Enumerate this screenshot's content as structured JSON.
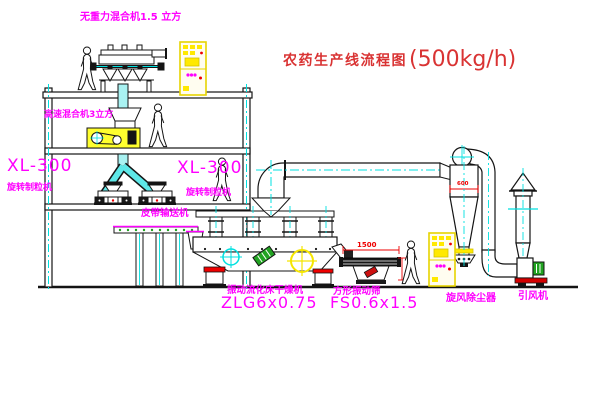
{
  "title": {
    "text": "农药生产线流程图",
    "capacity": "(500kg/h)"
  },
  "labels": {
    "gravity_mixer": "无重力混合机1.5 立方",
    "high_speed_mixer": "高速混合机3立方",
    "granulator_left_model": "XL-300",
    "granulator_left_name": "旋转制粒机",
    "granulator_right_model": "XL-300",
    "granulator_right_name": "旋转制粒机",
    "belt_conveyor": "皮带输送机",
    "dryer_name": "振动流化床干燥机",
    "dryer_model": "ZLG6x0.75",
    "sieve_name": "方形振动筛",
    "sieve_model": "FS0.6x1.5",
    "cyclone": "旋风除尘器",
    "fan": "引风机"
  },
  "dimensions": {
    "cyclone_diameter": "600",
    "sieve_length": "1500"
  },
  "colors": {
    "label_magenta": "#ff00ff",
    "title_red": "#d93333",
    "dimension_red": "#ee0000",
    "highlight_yellow": "#ffe900",
    "pipe_cyan": "#00e0e0",
    "machine_green": "#21a321",
    "line_black": "#141414"
  }
}
